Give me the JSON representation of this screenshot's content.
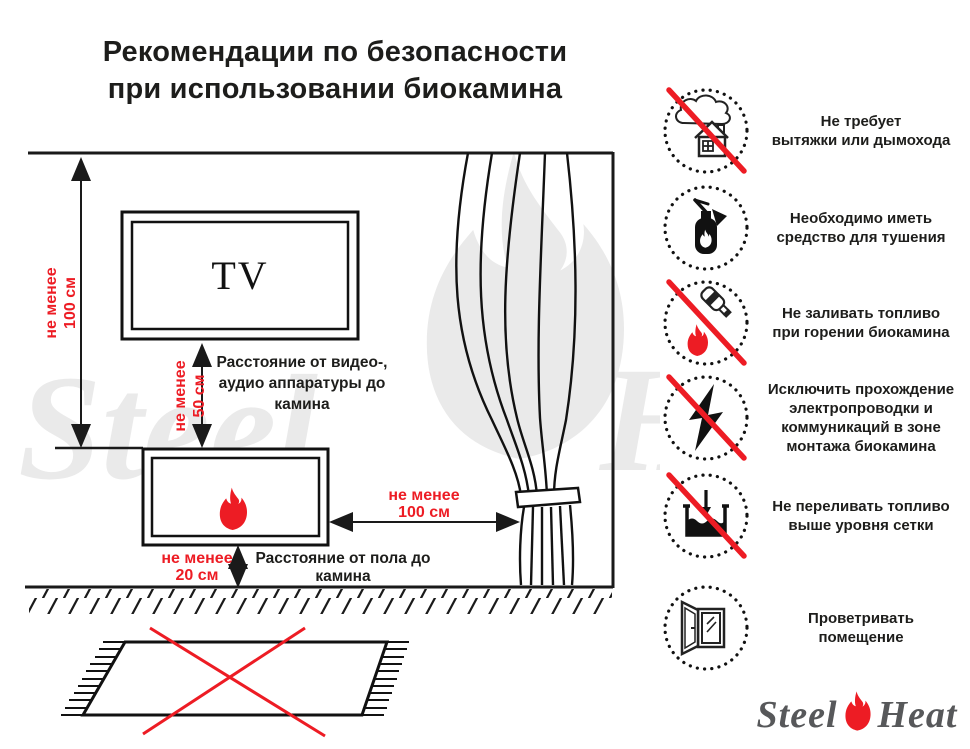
{
  "title": {
    "lines": [
      "Рекомендации по безопасности",
      "при использовании биокамина"
    ]
  },
  "diagram": {
    "tv_label": "TV",
    "labels": {
      "wall": {
        "lines": [
          "не менее",
          "100 см"
        ]
      },
      "tv_gap": {
        "lines": [
          "не менее",
          "50 см"
        ]
      },
      "curtain_gap": {
        "lines": [
          "не менее",
          "100 см"
        ]
      },
      "floor_gap": {
        "lines": [
          "не менее",
          "20 см"
        ]
      }
    },
    "captions": {
      "av": {
        "lines": [
          "Расстояние от видео-,",
          "аудио аппаратуры до",
          "камина"
        ]
      },
      "floor": {
        "lines": [
          "Расстояние от пола до",
          "камина"
        ]
      }
    },
    "elements": [
      "ceiling",
      "wall",
      "floor-hatched",
      "tv",
      "biofireplace-with-flame",
      "curtain-tied",
      "carpet-crossed-out"
    ]
  },
  "rules": [
    {
      "icon": "no-chimney-icon",
      "lines": [
        "Не требует",
        "вытяжки или дымохода"
      ]
    },
    {
      "icon": "extinguisher-icon",
      "lines": [
        "Необходимо иметь",
        "средство для тушения"
      ]
    },
    {
      "icon": "no-refuel-while-burning-icon",
      "lines": [
        "Не заливать топливо",
        "при горении биокамина"
      ]
    },
    {
      "icon": "no-electrical-wiring-icon",
      "lines": [
        "Исключить прохождение",
        "электропроводки и",
        "коммуникаций в зоне",
        "монтажа биокамина"
      ]
    },
    {
      "icon": "no-overfill-icon",
      "lines": [
        "Не переливать топливо",
        "выше уровня сетки"
      ]
    },
    {
      "icon": "ventilate-window-icon",
      "lines": [
        "Проветривать",
        "помещение"
      ]
    }
  ],
  "logo": {
    "steel": "Steel",
    "heat": "Heat"
  },
  "watermark": {
    "steel": "Steel",
    "heat": "Heat"
  },
  "colors": {
    "accent_red": "#ed1c24",
    "ink": "#1d1d1b",
    "logo_gray": "#57585a",
    "watermark_gray": "#eaeaea"
  }
}
